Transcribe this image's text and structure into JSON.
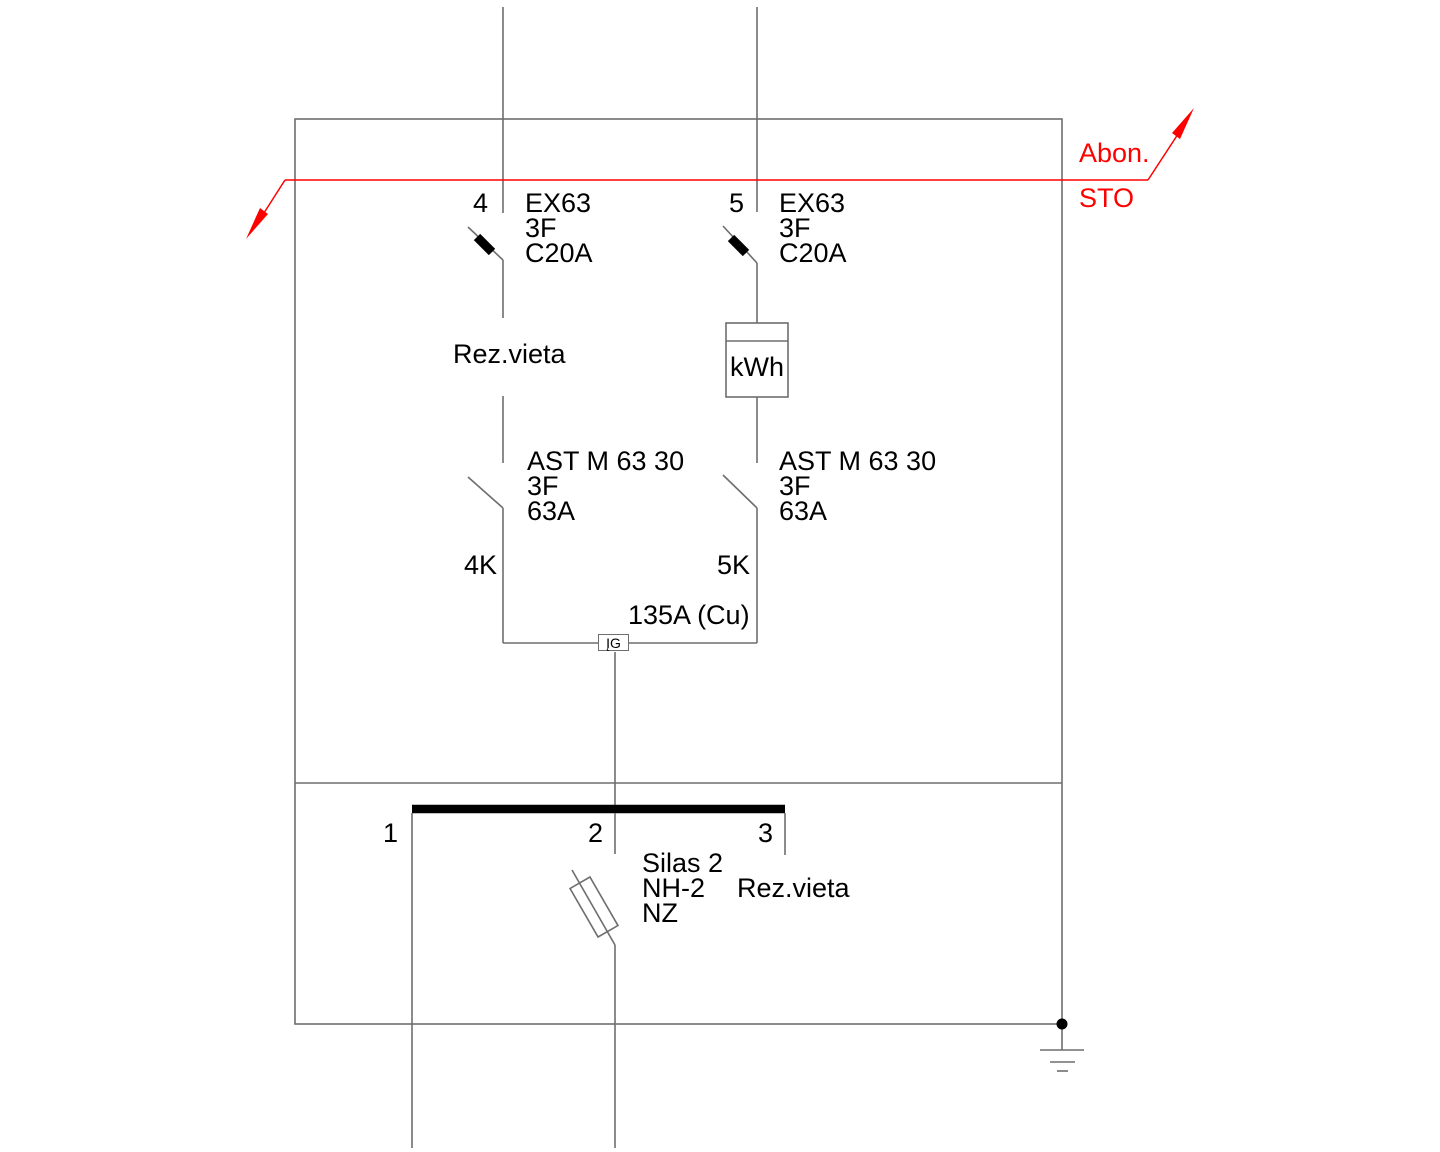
{
  "colors": {
    "line_gray": "#6e6e6e",
    "ink_black": "#000000",
    "accent_red": "#ff0000"
  },
  "incoming": {
    "label_top": "Abon.",
    "label_bottom": "STO"
  },
  "feeders": [
    {
      "id": "4",
      "breaker": {
        "model": "EX63",
        "phases": "3F",
        "rating": "C20A"
      },
      "note": "Rez.vieta",
      "switch": {
        "model": "AST M 63 30",
        "phases": "3F",
        "rating": "63A"
      },
      "tag": "4K"
    },
    {
      "id": "5",
      "breaker": {
        "model": "EX63",
        "phases": "3F",
        "rating": "C20A"
      },
      "meter": "kWh",
      "switch": {
        "model": "AST M 63 30",
        "phases": "3F",
        "rating": "63A"
      },
      "tag": "5K"
    }
  ],
  "tie": {
    "conductor": "135A (Cu)",
    "device": "ĮG"
  },
  "bus": {
    "outgoing": [
      {
        "id": "1"
      },
      {
        "id": "2",
        "fuse": {
          "line1": "Silas 2",
          "line2": "NH-2",
          "line3": "NZ"
        }
      },
      {
        "id": "3",
        "note": "Rez.vieta"
      }
    ]
  }
}
